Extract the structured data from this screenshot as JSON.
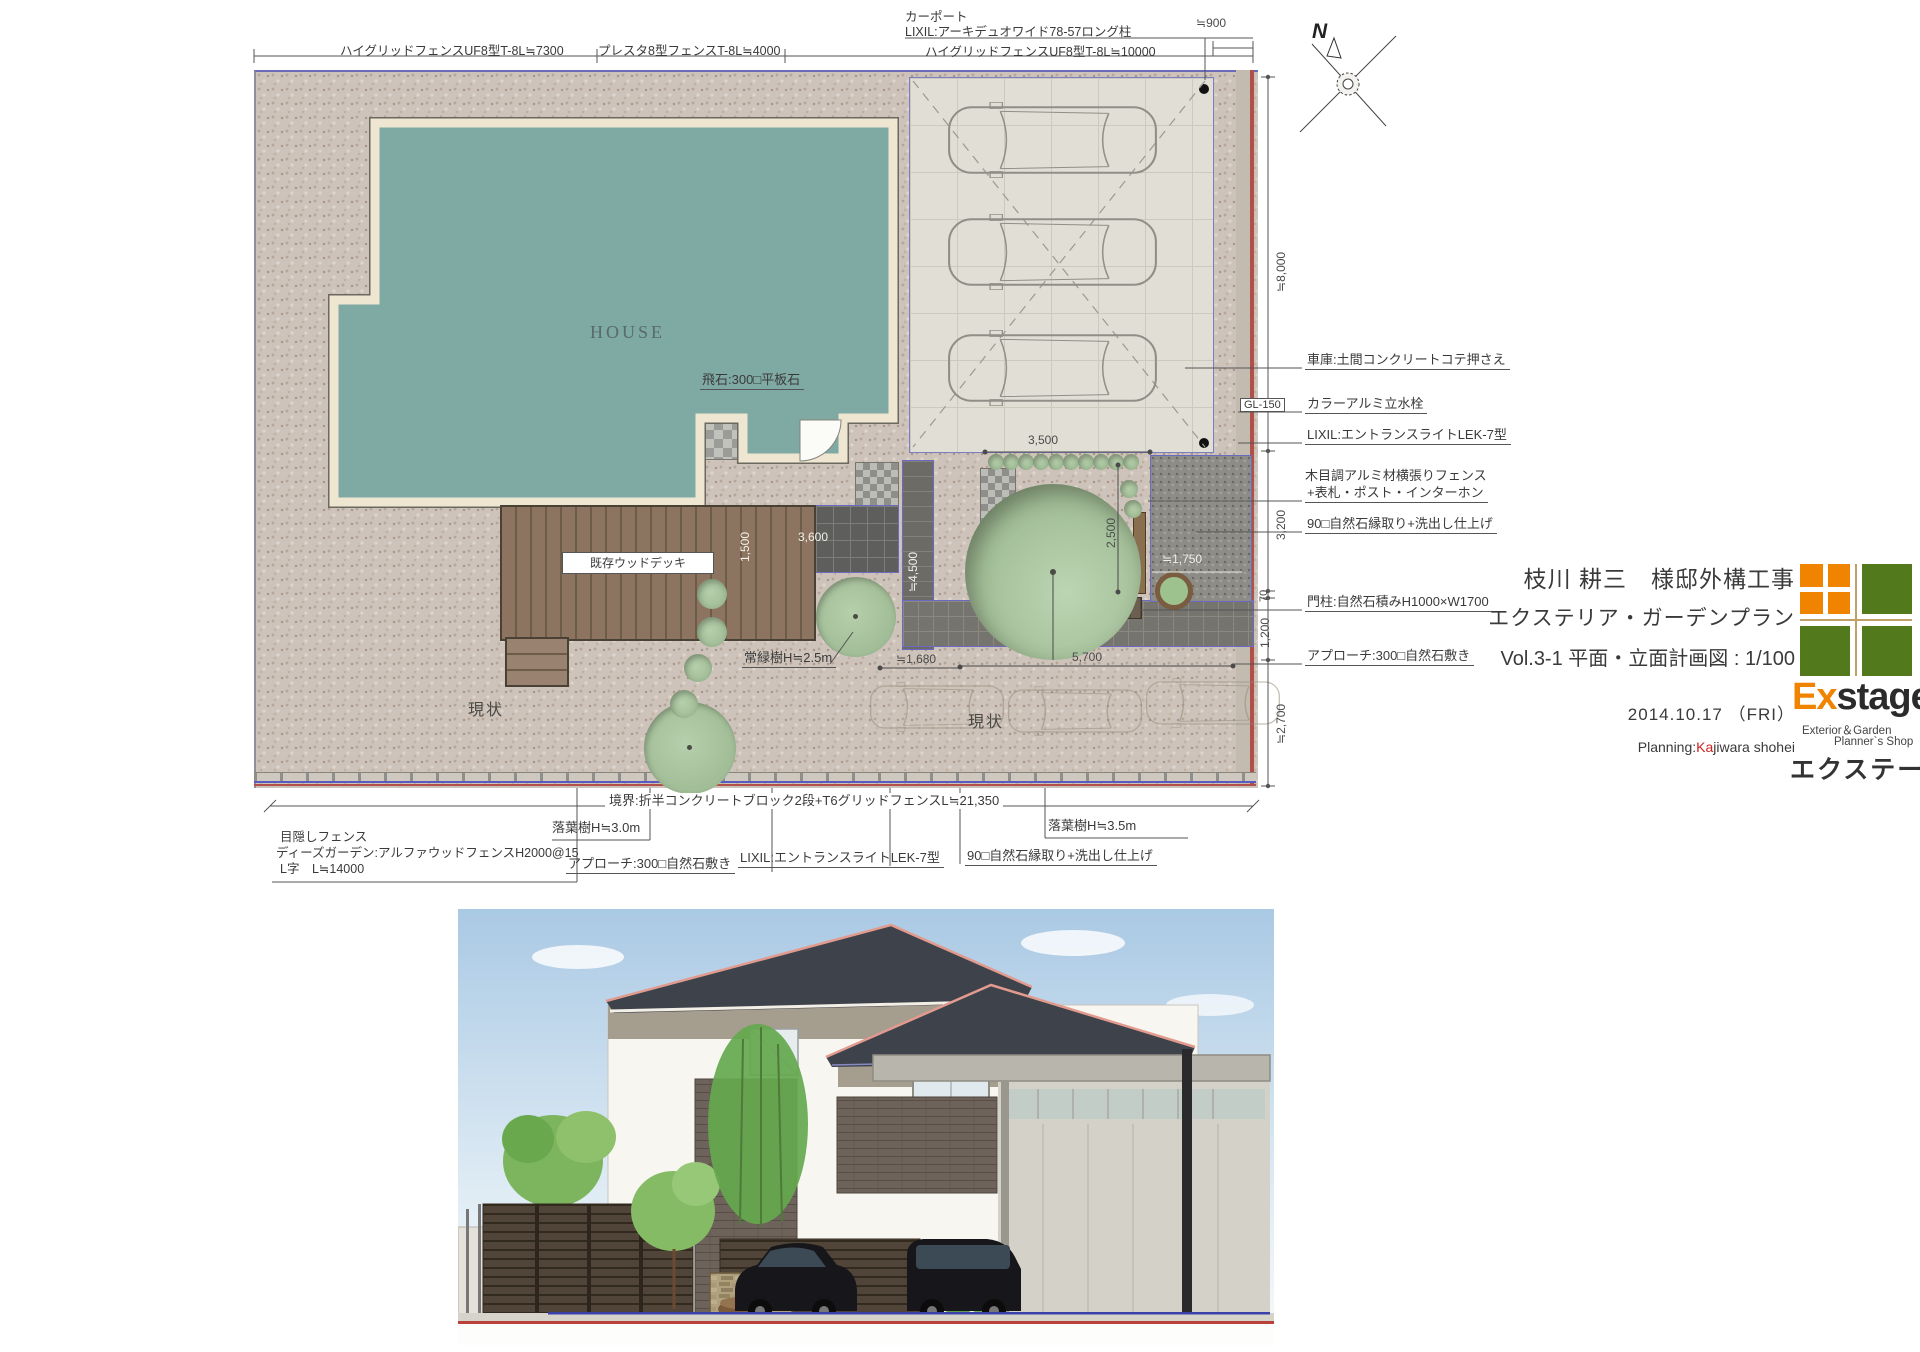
{
  "plan": {
    "fence_top": [
      "ハイグリッドフェンスUF8型T-8L≒7300",
      "プレスタ8型フェンスT-8L≒4000",
      "ハイグリッドフェンスUF8型T-8L≒10000"
    ],
    "carport_label": [
      "カーポート",
      "LIXIL:アーキデュオワイド78-57ロング柱"
    ],
    "north": "N",
    "labels": {
      "house": "HOUSE",
      "tobiishi": "飛石:300□平板石",
      "deck": "既存ウッドデッキ",
      "evergreen": "常緑樹H≒2.5m",
      "existing": "現状",
      "gl": "GL-150"
    },
    "dims": {
      "d900": "≒900",
      "d8000": "≒8,000",
      "d3200": "3,200",
      "d70": "70",
      "d1200": "1,200",
      "d2700": "≒2,700",
      "d1500": "1,500",
      "d3600": "3,600",
      "d4500": "≒4,500",
      "d3500": "3,500",
      "d2500": "2,500",
      "d1750": "≒1,750",
      "d1680": "≒1,680",
      "d5700": "5,700"
    },
    "ann_right": [
      "車庫:土間コンクリートコテ押さえ",
      "カラーアルミ立水栓",
      "LIXIL:エントランスライトLEK-7型",
      "木目調アルミ材横張りフェンス",
      "+表札・ポスト・インターホン",
      "90□自然石縁取り+洗出し仕上げ",
      "門柱:自然石積みH1000×W1700",
      "アプローチ:300□自然石敷き"
    ],
    "ann_bottom": {
      "boundary": "境界:折半コンクリートブロック2段+T6グリッドフェンスL≒21,350",
      "tree30": "落葉樹H≒3.0m",
      "tree35": "落葉樹H≒3.5m",
      "fence1": "目隠しフェンス",
      "fence2": "ディーズガーデン:アルファウッドフェンスH2000@15",
      "fence3": "L字　L≒14000",
      "approach": "アプローチ:300□自然石敷き",
      "light": "LIXIL:エントランスライトLEK-7型",
      "stone": "90□自然石縁取り+洗出し仕上げ"
    }
  },
  "title_block": {
    "client": "枝川 耕三　様邸外構工事",
    "plan_type": "エクステリア・ガーデンプラン",
    "sheet_title": "Vol.3-1 平面・立面計画図 : 1/100",
    "date": "2014.10.17 （FRI）",
    "planning_label": "Planning:",
    "planner_head": "Ka",
    "planner_rest": "jiwara shohei",
    "brand_ex": "Ex",
    "brand_stage": "stage",
    "brand_sub1": "Exterior＆Garden",
    "brand_sub2": "Planner`s Shop",
    "brand_kana": "エクステージ"
  },
  "colors": {
    "house_fill": "#7FA9A3",
    "house_border": "#EFE6D2",
    "boundary_blue": "#6A6AC0",
    "boundary_red": "#B05048",
    "brand_orange": "#F08300",
    "brand_green": "#527A1C",
    "planner_red": "#CC2222",
    "roof": "#3E434B",
    "ridge_pink": "#E29A8E",
    "sky": "#AAC9E4"
  }
}
